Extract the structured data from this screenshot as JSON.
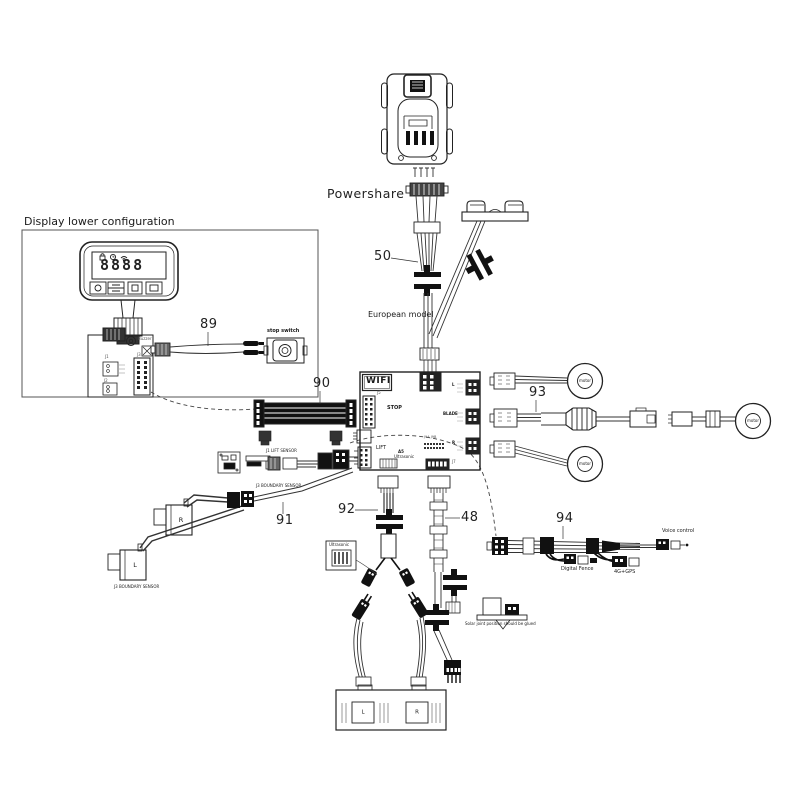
{
  "labels": {
    "powershare": "Powershare",
    "display_config": "Display lower configuration",
    "european_model": "European model",
    "stop_switch": "stop switch",
    "lift_sensor": "J1 LIFT SENSOR",
    "boundary_sensor_top": "J3 BOUNDARY SENSOR",
    "boundary_sensor_bottom": "J3 BOUNDARY SENSOR",
    "ultrasonic_box": "Ultrasonic",
    "voice_control": "Voice control",
    "digital_fence": "Digital Fence",
    "gps": "4G+GPS",
    "solar_note": "Solar joint position should be glued"
  },
  "parts": {
    "p48": "48",
    "p50": "50",
    "p89": "89",
    "p90": "90",
    "p91": "91",
    "p92": "92",
    "p93": "93",
    "p94": "94"
  },
  "board": {
    "wifi": "WIFI",
    "stop": "STOP",
    "lift": "LIFT",
    "a5": "A5",
    "ultrasonic": "Ultrasonic",
    "blade": "BLADE",
    "conn_l": "L",
    "conn_r": "R",
    "j5": "J5",
    "j7": "J7",
    "j9": "J9A J9B"
  },
  "pcb": {
    "j1": "J1",
    "j2": "J2",
    "j3": "J3",
    "buzzer": "Buzzer"
  },
  "display": {
    "digits": "8888"
  },
  "motor": "motor",
  "boundary": {
    "r": "R",
    "l": "L"
  },
  "block": {
    "l": "L",
    "r": "R"
  }
}
